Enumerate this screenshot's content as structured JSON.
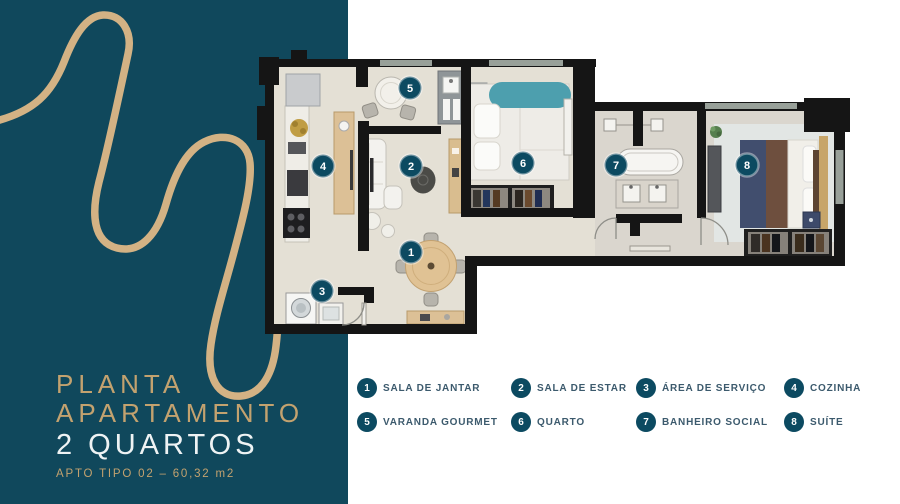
{
  "sidebar": {
    "title_line1": "PLANTA",
    "title_line2": "APARTAMENTO",
    "title_line3": "2 QUARTOS",
    "subtitle": "APTO TIPO 02 – 60,32 m2"
  },
  "legend": {
    "items": [
      {
        "number": "1",
        "label": "SALA DE JANTAR"
      },
      {
        "number": "2",
        "label": "SALA DE ESTAR"
      },
      {
        "number": "3",
        "label": "ÁREA DE SERVIÇO"
      },
      {
        "number": "4",
        "label": "COZINHA"
      },
      {
        "number": "5",
        "label": "VARANDA GOURMET"
      },
      {
        "number": "6",
        "label": "QUARTO"
      },
      {
        "number": "7",
        "label": "BANHEIRO SOCIAL"
      },
      {
        "number": "8",
        "label": "SUÍTE"
      }
    ]
  },
  "colors": {
    "panel_teal": "#10485c",
    "marker_teal": "#0c4a61",
    "gold_line": "#d3b284",
    "title_gold": "#c3a26f",
    "legend_text": "#3c5a6d",
    "wall_black": "#151515",
    "floor_beige": "#e4e0d5"
  }
}
